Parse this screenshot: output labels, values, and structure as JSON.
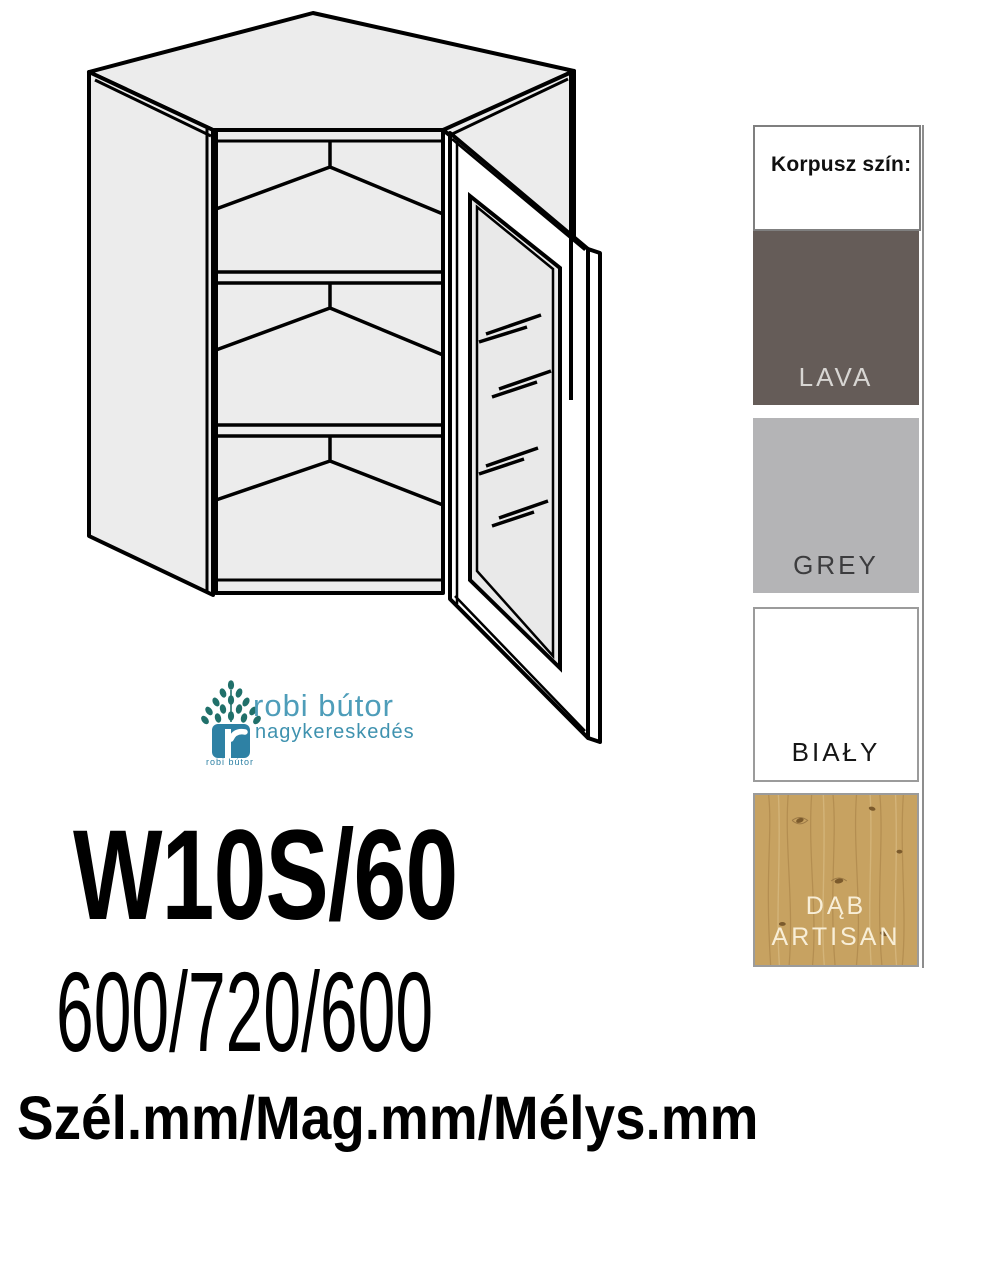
{
  "product": {
    "code": "W10S/60",
    "dimensions": "600/720/600",
    "dimensions_caption": "Szél.mm/Mag.mm/Mélys.mm"
  },
  "logo": {
    "name": "robi bútor",
    "subtitle": "nagykereskedés",
    "icon_caption": "robi bútor",
    "name_color": "#4e9db9",
    "icon_color": "#2e81a4",
    "leaf_color": "#20706a"
  },
  "color_panel": {
    "header": "Korpusz szín:",
    "options": [
      {
        "label": "LAVA",
        "color": "#655c58",
        "label_color": "#d8d6d3"
      },
      {
        "label": "GREY",
        "color": "#b4b4b6",
        "label_color": "#3c3c3e"
      },
      {
        "label": "BIAŁY",
        "color": "#ffffff",
        "label_color": "#161616"
      },
      {
        "label": "DĄB ARTISAN",
        "color": "#c7a261",
        "label_color": "#f8eed7"
      }
    ]
  },
  "diagram": {
    "subject": "corner wall cabinet with open glass door and two shelves",
    "fill_color": "#ececec",
    "line_color": "#000000"
  }
}
